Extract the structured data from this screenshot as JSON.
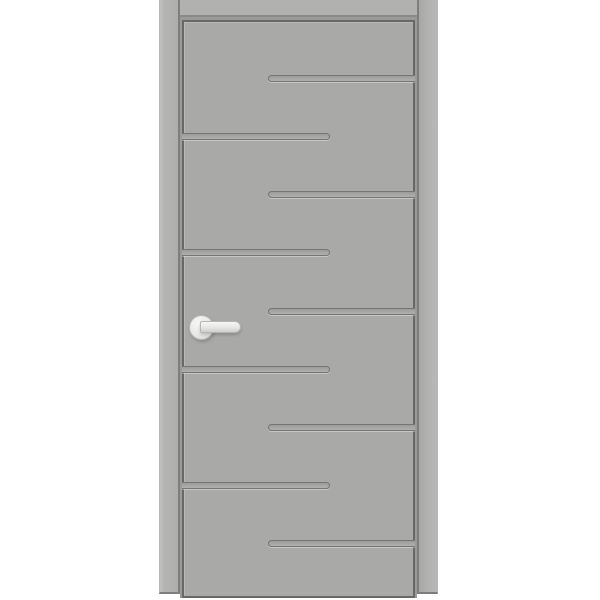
{
  "image": {
    "type": "product-render",
    "subject": "grey interior door with alternating horizontal groove slots and white lever handle",
    "background_color": "#ffffff"
  },
  "door": {
    "frame": {
      "color": "#b1b1af",
      "edge_color": "#7e7e7c",
      "head_edge_color": "#8a8a88"
    },
    "slab": {
      "color": "#a9a9a7",
      "outline_color": "#686866",
      "reveal_color": "#9a9a98"
    },
    "grooves": {
      "line_color": "#757573",
      "pattern": "alternating, attached to right edge then left edge, rounded free end",
      "items": [
        {
          "side": "right",
          "top": 53
        },
        {
          "side": "left",
          "top": 111
        },
        {
          "side": "right",
          "top": 169
        },
        {
          "side": "left",
          "top": 227
        },
        {
          "side": "right",
          "top": 286
        },
        {
          "side": "left",
          "top": 344
        },
        {
          "side": "right",
          "top": 402
        },
        {
          "side": "left",
          "top": 460
        },
        {
          "side": "right",
          "top": 518
        }
      ]
    },
    "handle": {
      "style": "lever on round rose",
      "color": "#ebebeb",
      "outline_color": "#b5b5b3",
      "position": "left side, mid height"
    }
  }
}
